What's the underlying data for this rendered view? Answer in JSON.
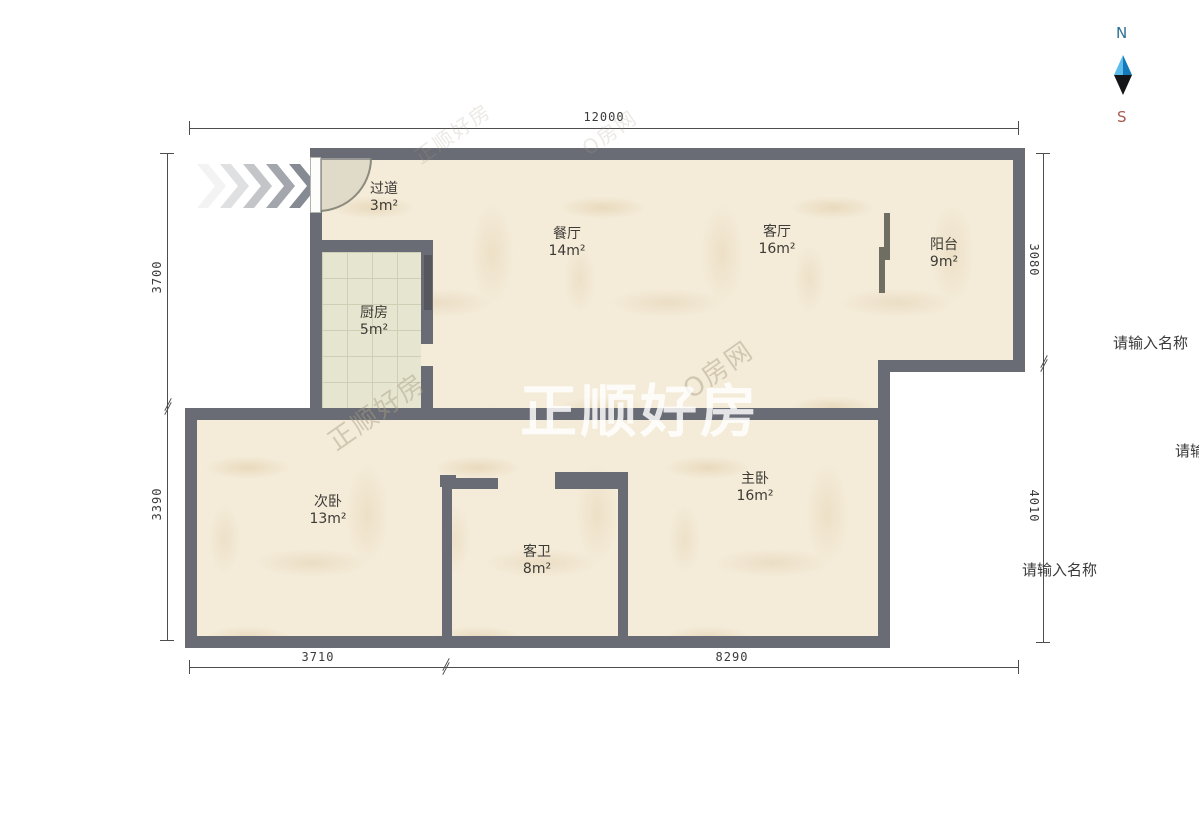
{
  "compass": {
    "north": "N",
    "south": "S"
  },
  "rooms": [
    {
      "name": "过道",
      "area": "3m²"
    },
    {
      "name": "餐厅",
      "area": "14m²"
    },
    {
      "name": "客厅",
      "area": "16m²"
    },
    {
      "name": "阳台",
      "area": "9m²"
    },
    {
      "name": "厨房",
      "area": "5m²"
    },
    {
      "name": "次卧",
      "area": "13m²"
    },
    {
      "name": "客卫",
      "area": "8m²"
    },
    {
      "name": "主卧",
      "area": "16m²"
    }
  ],
  "dimensions": {
    "top_total": "12000",
    "left_upper": "3700",
    "left_lower": "3390",
    "right_upper": "3080",
    "right_lower": "4010",
    "bottom_left": "3710",
    "bottom_right": "8290"
  },
  "placeholders": {
    "right_top": "请输入名称",
    "right_middle": "请输入名称",
    "right_bottom": "请输入名称"
  },
  "watermarks": {
    "center": "正顺好房",
    "diagonal_a": "正顺好房",
    "diagonal_b": "O房网",
    "diagonal_c": "正顺好房",
    "diagonal_d": "O房网"
  },
  "colors": {
    "wall": "#696c75",
    "floor": "#f4ebd8",
    "kitchen_tile": "#e6e6d0",
    "dimension_line": "#4d4d4d",
    "compass_north": "#2d6f96",
    "compass_south": "#a85a4e",
    "compass_needle_blue": "#2196d3",
    "compass_needle_black": "#141518"
  }
}
